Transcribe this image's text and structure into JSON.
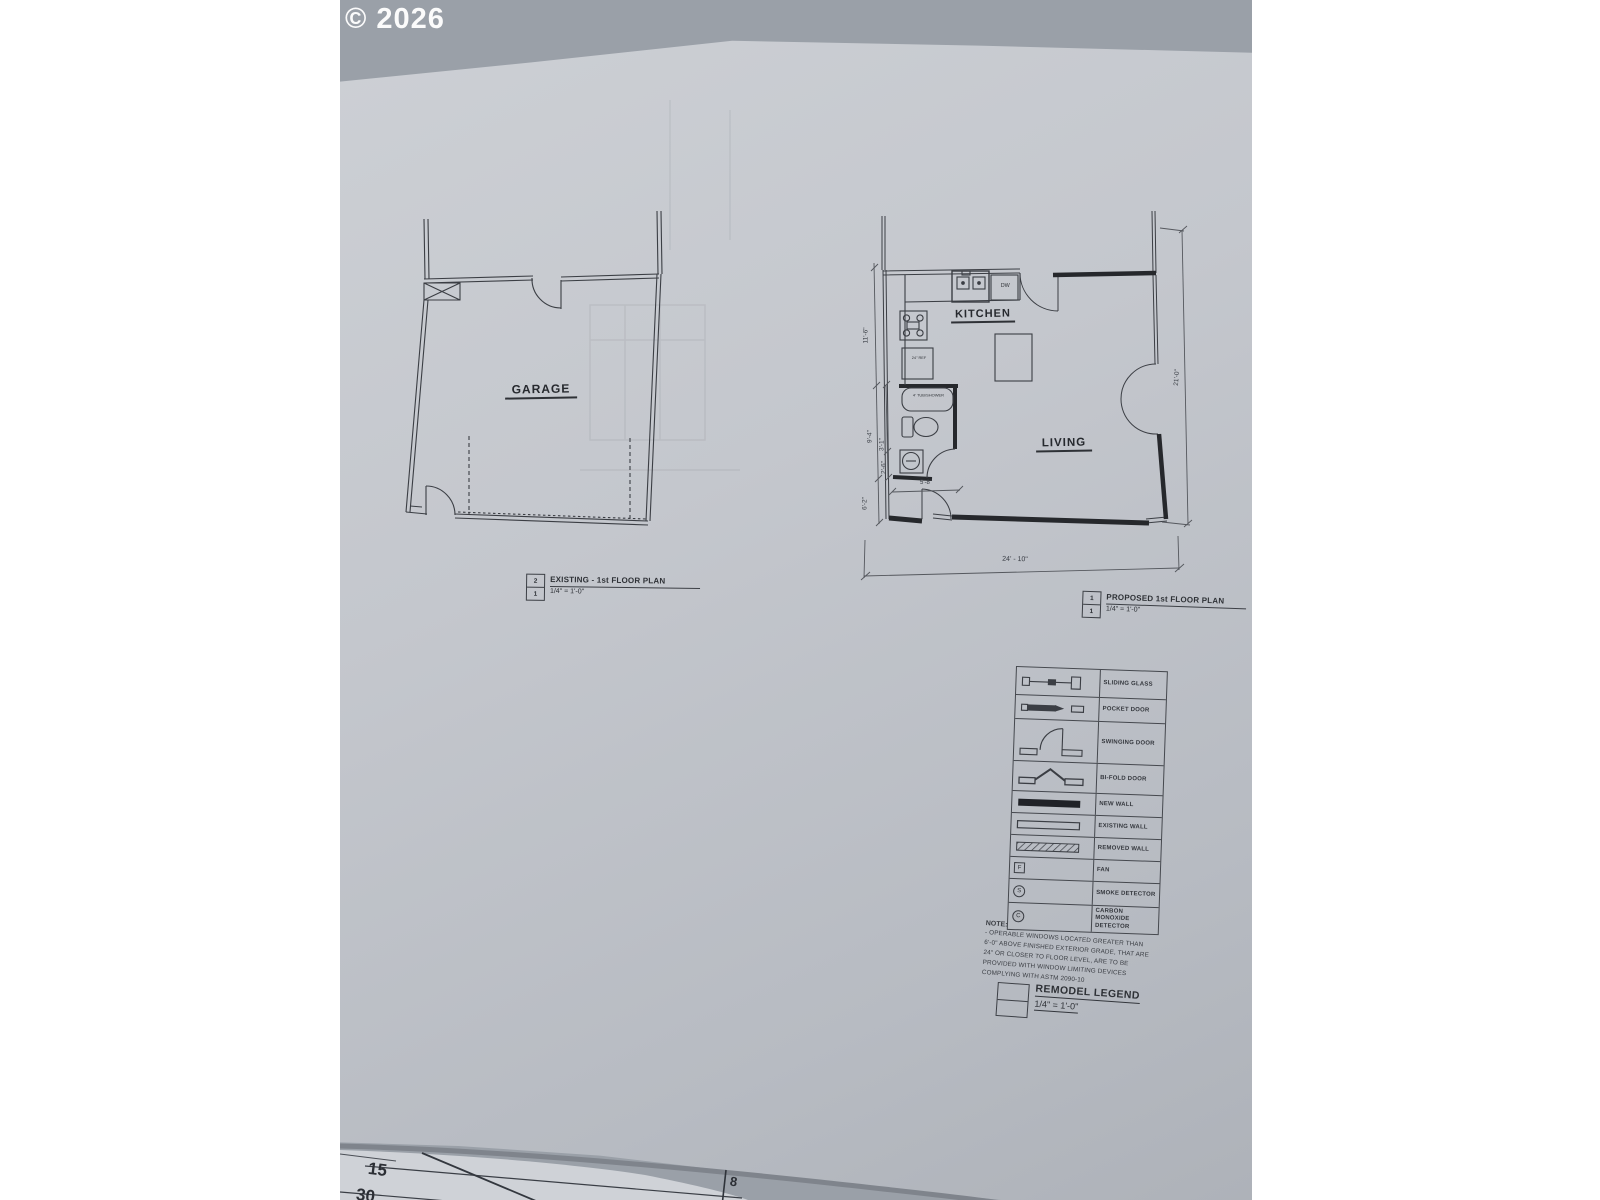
{
  "watermark": "© 2026",
  "colors": {
    "ink": "#3b3e44",
    "new_wall": "#26282c",
    "paper": "#c4c7cd",
    "backdrop": "#9aa0a8"
  },
  "existing_plan": {
    "room_label": "GARAGE",
    "callout": {
      "number": "2",
      "sheet": "1",
      "title": "EXISTING - 1st FLOOR PLAN",
      "scale": "1/4\" = 1'-0\""
    }
  },
  "proposed_plan": {
    "kitchen_label": "KITCHEN",
    "living_label": "LIVING",
    "tub_label": "4' TUB/SHOWER",
    "dw_label": "DW",
    "ref_label": "24\" REF",
    "dims": {
      "left_overall": "11'-6\"",
      "left_mid": "9'-4\"",
      "left_sub1": "3'-1\"",
      "left_sub2": "2'-6\"",
      "left_bottom": "6'-2\"",
      "bath_width": "5'-8\"",
      "bottom_overall": "24' - 10\"",
      "right_overall": "21'-0\""
    },
    "callout": {
      "number": "1",
      "sheet": "1",
      "title": "PROPOSED 1st FLOOR PLAN",
      "scale": "1/4\" = 1'-0\""
    }
  },
  "legend": {
    "rows": [
      {
        "symbol": "sliding-glass-door-symbol",
        "label": "SLIDING GLASS"
      },
      {
        "symbol": "pocket-door-symbol",
        "label": "POCKET DOOR"
      },
      {
        "symbol": "swinging-door-symbol",
        "label": "SWINGING DOOR"
      },
      {
        "symbol": "bi-fold-door-symbol",
        "label": "BI-FOLD DOOR"
      },
      {
        "symbol": "new-wall-symbol",
        "label": "NEW WALL"
      },
      {
        "symbol": "existing-wall-symbol",
        "label": "EXISTING WALL"
      },
      {
        "symbol": "removed-wall-symbol",
        "label": "REMOVED WALL"
      },
      {
        "symbol": "fan-symbol",
        "label": "FAN",
        "glyph": "F"
      },
      {
        "symbol": "smoke-detector-symbol",
        "label": "SMOKE DETECTOR",
        "glyph": "S"
      },
      {
        "symbol": "carbon-monoxide-detector-symbol",
        "label": "CARBON MONOXIDE DETECTOR",
        "glyph": "C"
      }
    ]
  },
  "note": {
    "heading": "NOTE:",
    "lines": [
      "- OPERABLE WINDOWS LOCATED GREATER THAN",
      "6'-0\" ABOVE FINISHED EXTERIOR GRADE, THAT ARE",
      "24\" OR CLOSER TO FLOOR LEVEL, ARE TO BE",
      "PROVIDED WITH WINDOW LIMITING DEVICES",
      "COMPLYING WITH ASTM 2090-10"
    ]
  },
  "remodel_legend": {
    "title": "REMODEL LEGEND",
    "scale": "1/4\" = 1'-0\""
  },
  "under_sheet": {
    "numbers": [
      "15",
      "30",
      "8"
    ]
  }
}
